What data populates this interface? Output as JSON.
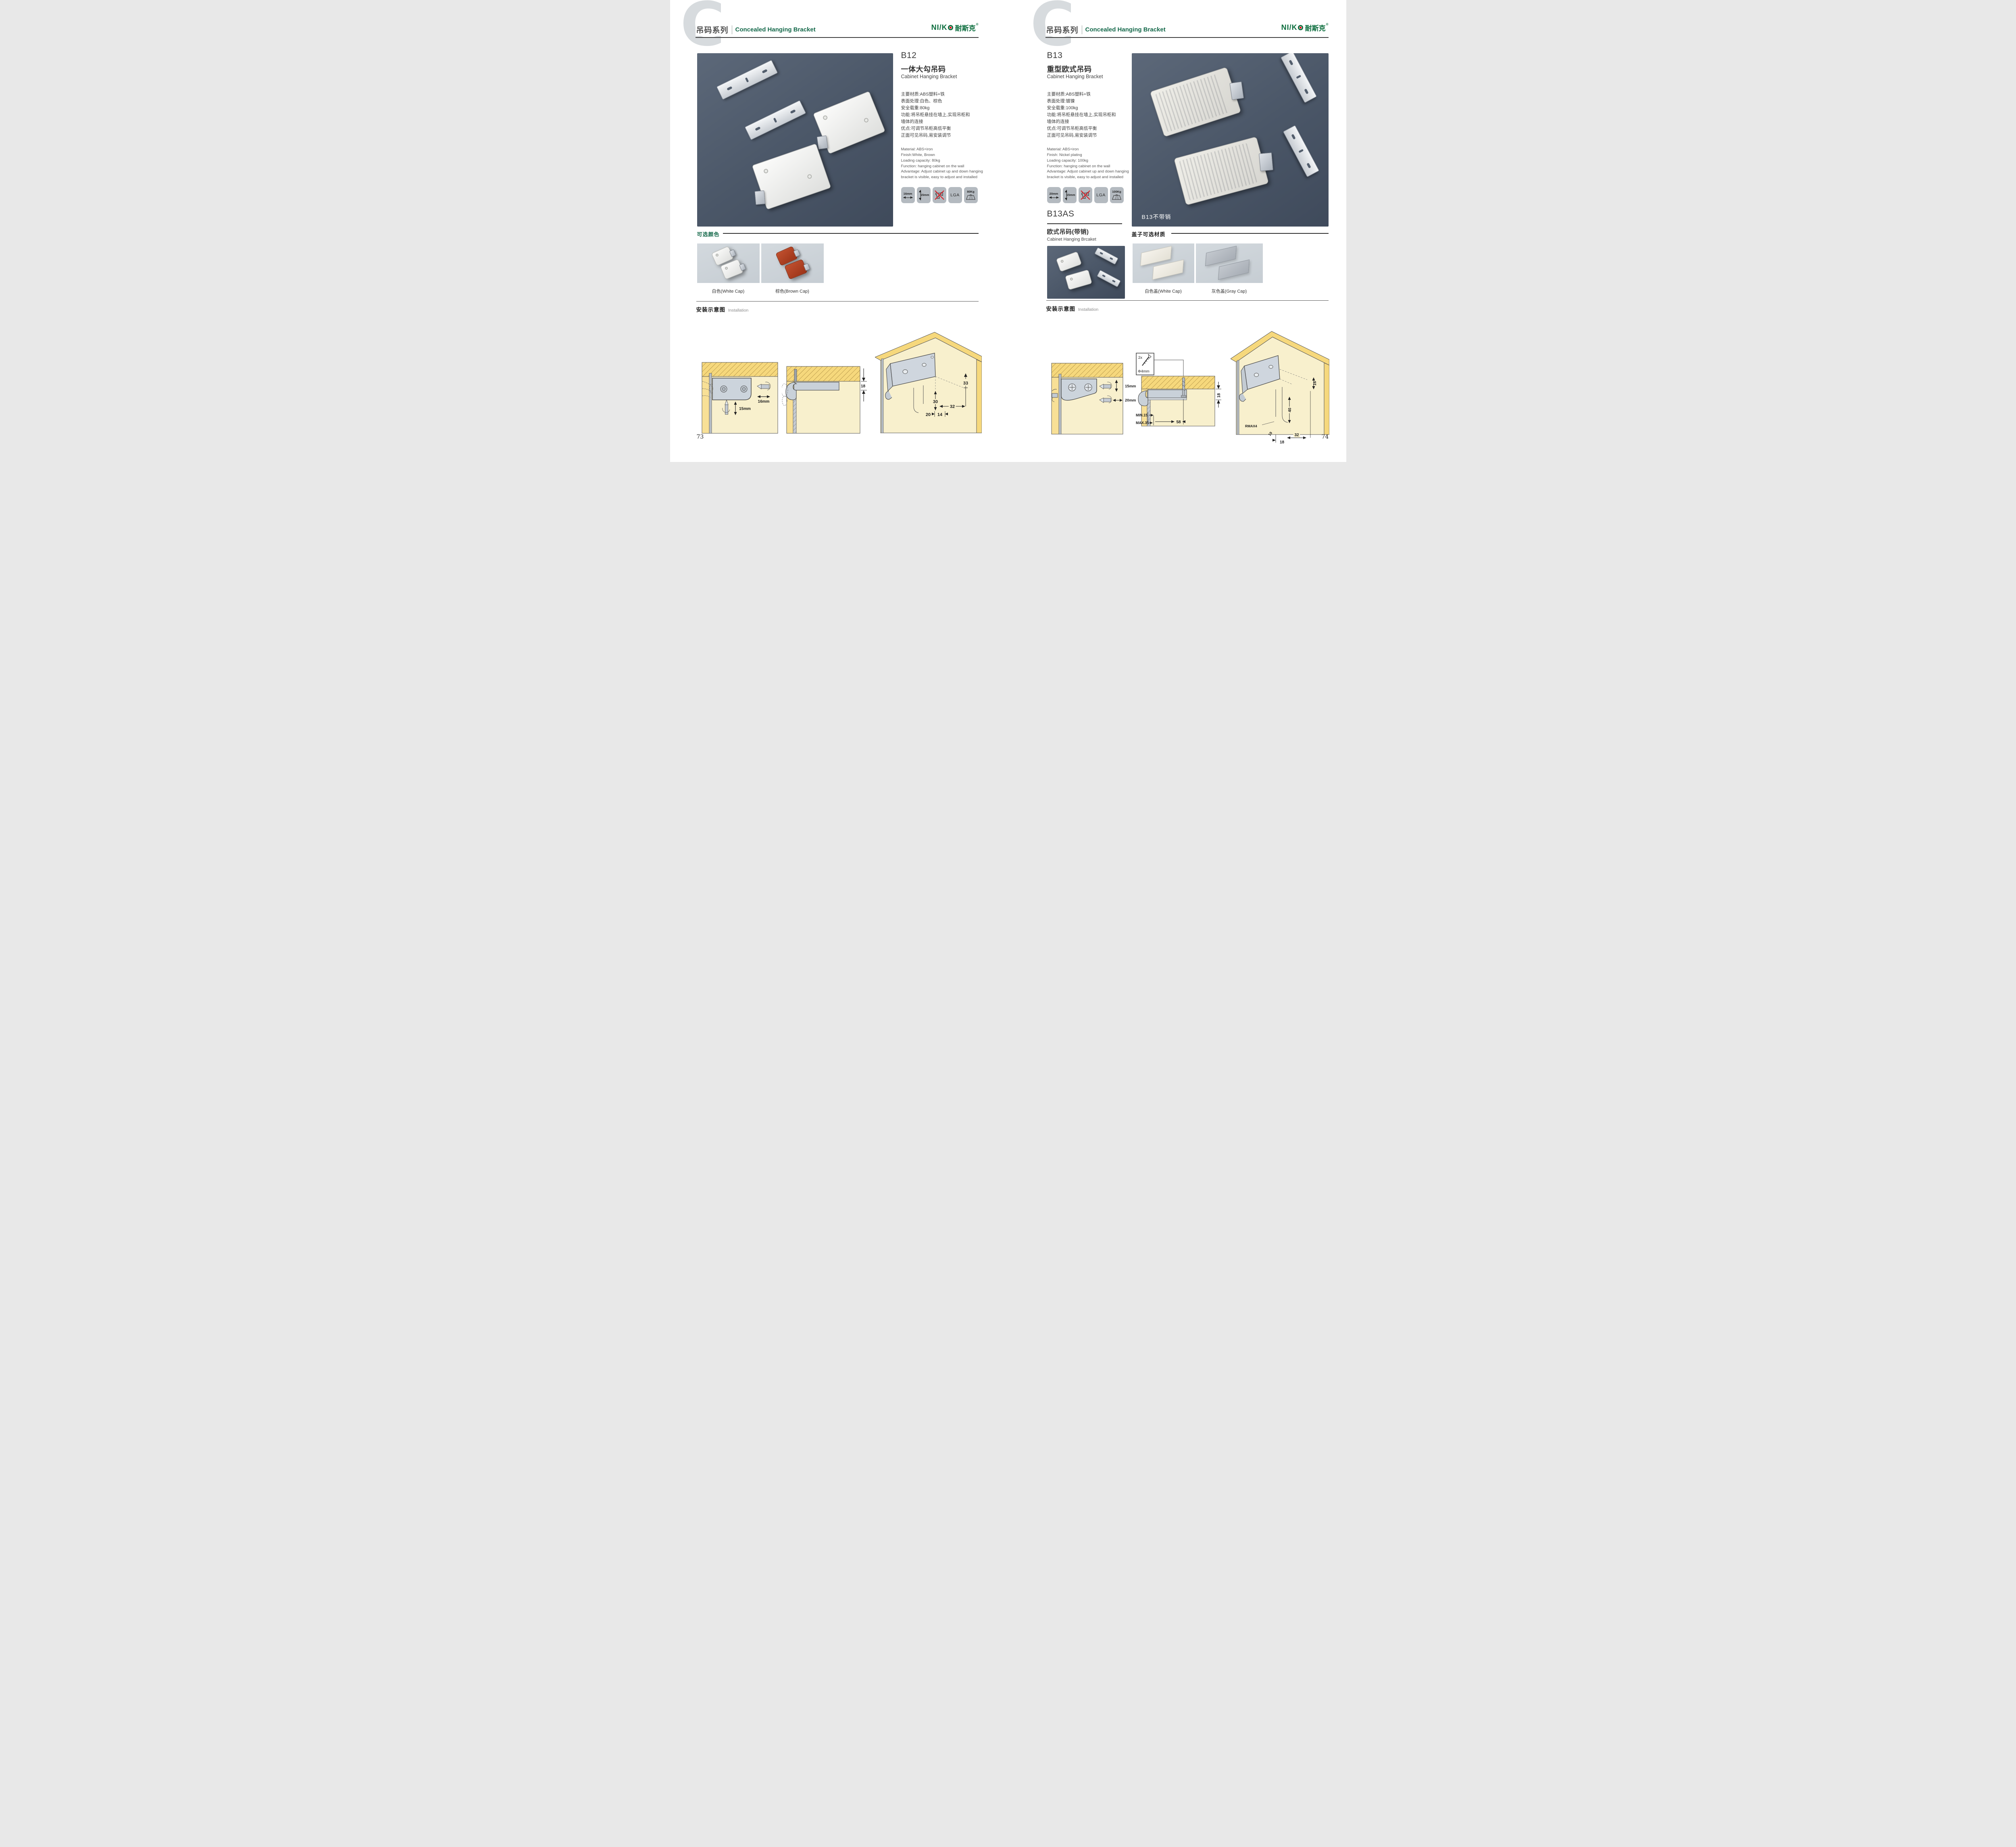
{
  "header": {
    "series_cn": "吊码系列",
    "series_en": "Concealed Hanging Bracket",
    "letter": "C",
    "logo_latin": "NI/K",
    "logo_cn": "耐斯克",
    "logo_reg": "®"
  },
  "left": {
    "page_number": "73",
    "product": {
      "code": "B12",
      "name_cn": "一体大勾吊码",
      "name_en": "Cabinet Hanging Bracket",
      "specs_cn": [
        "主要材质:ABS塑料+铁",
        "表面处理:白色、棕色",
        "安全载重:80kg",
        "功能:将吊柜悬挂在墙上,实现吊柜和",
        "墙体的连接",
        "优点:可调节吊柜高低平衡",
        "正面可见吊码,易安装调节"
      ],
      "specs_en": [
        "Material: ABS+iron",
        "Finish:White, Brown",
        "Loading capacity: 80kg",
        "Function: hanging cabinet on the wall",
        "Advantage: Adjust cabinet up and down hanging",
        "bracket is visible, easy to adjust and installed"
      ],
      "icon_width": "16mm",
      "icon_height": "15mm",
      "icon_cert": "LGA",
      "icon_load": "80Kg"
    },
    "colors": {
      "heading": "可选颜色",
      "caption_white": "白色(White Cap)",
      "caption_brown": "棕色(Brown Cap)"
    },
    "install": {
      "heading_cn": "安装示意图",
      "heading_en": "Installation",
      "d1_width": "16mm",
      "d1_height": "15mm",
      "d2_dim": "18",
      "d3_dims": {
        "a": "33",
        "b": "30",
        "c": "32",
        "d": "20",
        "e": "14"
      }
    }
  },
  "right": {
    "page_number": "74",
    "product": {
      "code": "B13",
      "name_cn": "重型欧式吊码",
      "name_en": "Cabinet Hanging Bracket",
      "specs_cn": [
        "主要材质:ABS塑料+铁",
        "表面处理:镀镍",
        "安全载重:100kg",
        "功能:将吊柜悬挂在墙上,实现吊柜和",
        "墙体的连接",
        "优点:可调节吊柜高低平衡",
        "正面可见吊码,易安装调节"
      ],
      "specs_en": [
        "Material: ABS+iron",
        "Finish: Nickel plating",
        "Loading capacity: 100kg",
        "Function: hanging cabinet on the wall",
        "Advantage: Adjust cabinet up and down hanging",
        "bracket is visible, easy to adjust and installed"
      ],
      "icon_width": "20mm",
      "icon_height": "15mm",
      "icon_cert": "LGA",
      "icon_load": "100Kg",
      "photo_label": "B13不带销"
    },
    "sub_product": {
      "code": "B13AS",
      "name_cn": "欧式吊码(带销)",
      "name_en": "Cabinet Hanging Brcaket"
    },
    "caps": {
      "heading": "盖子可选材质",
      "caption_white": "白色盖(White Cap)",
      "caption_gray": "灰色盖(Gray Cap)"
    },
    "install": {
      "heading_cn": "安装示意图",
      "heading_en": "Installation",
      "d1_height": "15mm",
      "d1_width": "20mm",
      "d2_count": "2x",
      "d2_screw": "Φ4mm",
      "d2_dim": "18",
      "d2_min": "MIN.15",
      "d2_max": "MAX.35",
      "d2_len": "58",
      "d3_dims": {
        "a": "16",
        "b": "40",
        "c": "RMAX4",
        "d": "19",
        "e": "18",
        "f": "32"
      }
    }
  }
}
